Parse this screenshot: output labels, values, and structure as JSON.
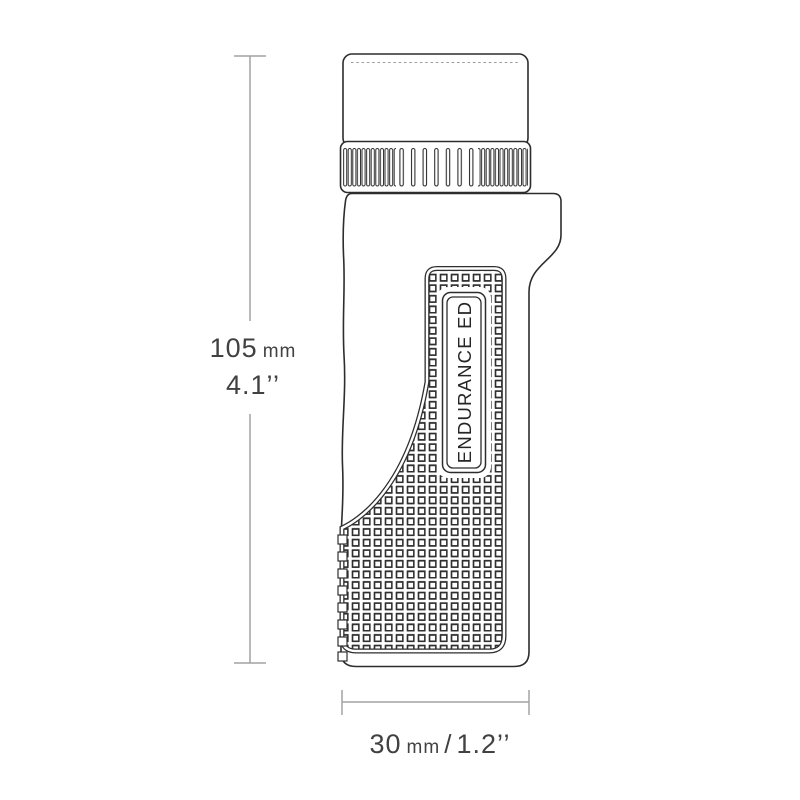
{
  "product": {
    "badge_text": "ENDURANCE ED"
  },
  "dimensions": {
    "height": {
      "value": "105",
      "unit": "mm",
      "imperial": "4.1’’"
    },
    "width": {
      "value": "30",
      "unit": "mm",
      "separator": "/",
      "imperial": "1.2’’"
    }
  },
  "colors": {
    "outline": "#2d2d2d",
    "dimension_lines": "#a2a2a2",
    "dimension_text": "#414141",
    "background": "#ffffff"
  }
}
